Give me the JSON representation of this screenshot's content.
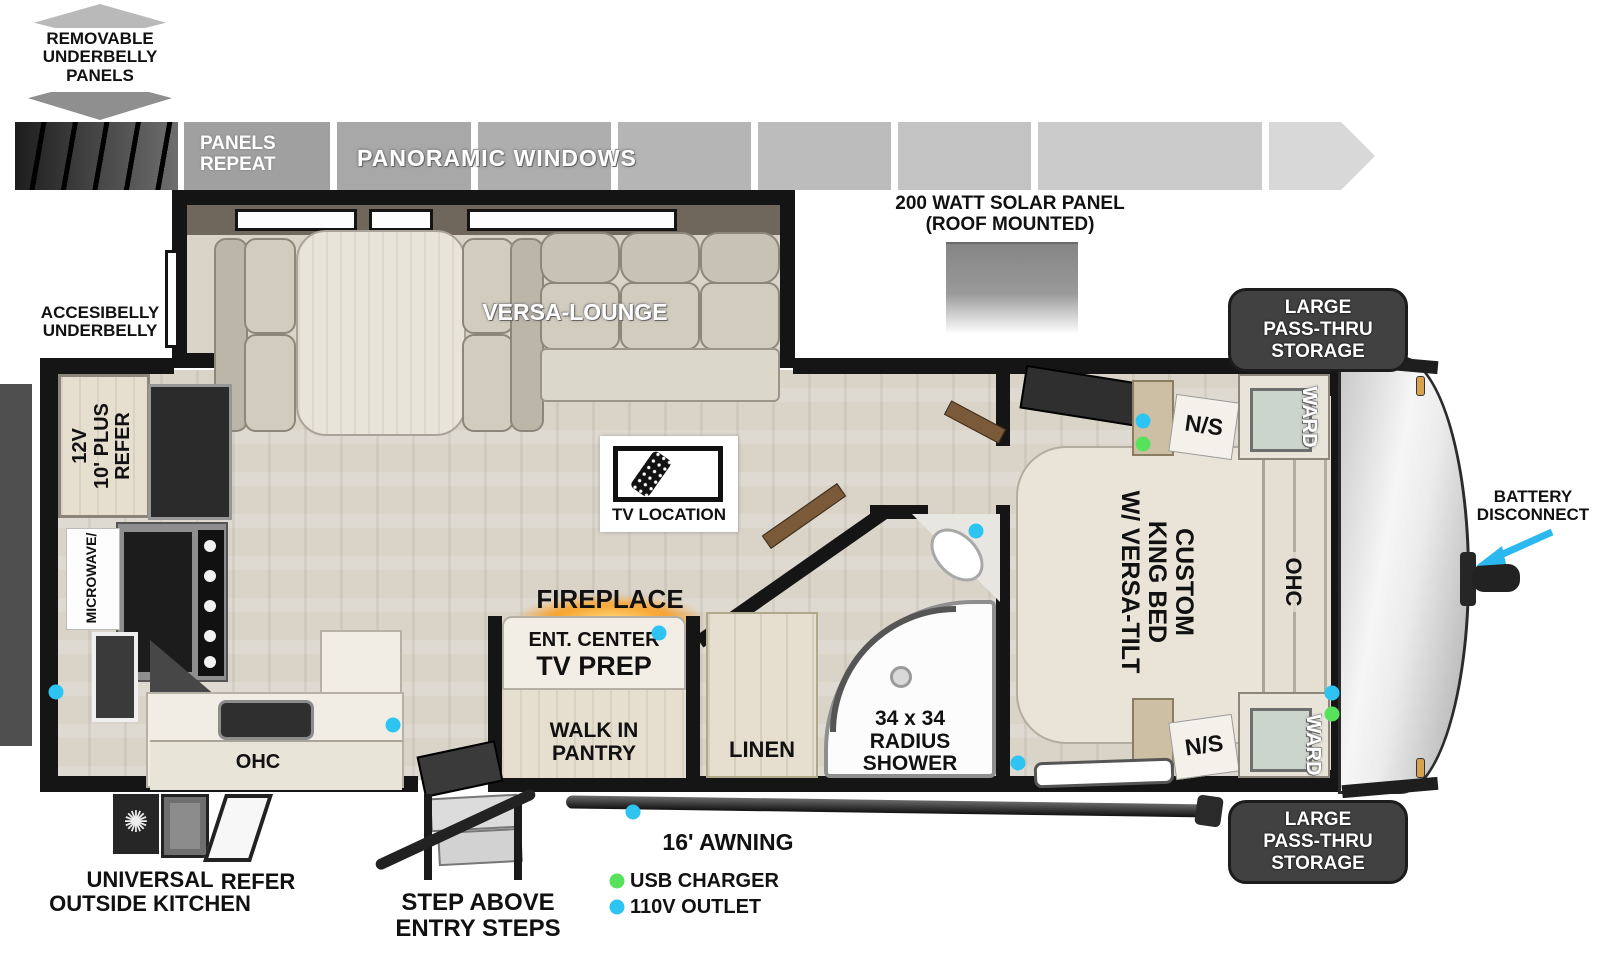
{
  "colors": {
    "outlet_110v": "#2ec4f2",
    "usb_charger": "#58e25c",
    "battery_arrow": "#2bb8ef",
    "fireplace_glow": "#f7a22e"
  },
  "top_band": {
    "removable_lines": [
      "REMOVABLE",
      "UNDERBELLY",
      "PANELS"
    ],
    "panels_repeat_lines": [
      "PANELS",
      "REPEAT"
    ],
    "panoramic_windows": "PANORAMIC WINDOWS",
    "solar_lines": [
      "200 WATT SOLAR PANEL",
      "(ROOF MOUNTED)"
    ]
  },
  "exterior": {
    "accesibelly_lines": [
      "ACCESIBELLY",
      "UNDERBELLY"
    ],
    "battery_lines": [
      "BATTERY",
      "DISCONNECT"
    ],
    "storage_lines": [
      "LARGE",
      "PASS-THRU",
      "STORAGE"
    ],
    "awning": "16' AWNING",
    "outside_kitchen_lines": [
      "UNIVERSAL",
      "OUTSIDE KITCHEN"
    ],
    "outside_refer": "REFER",
    "steps_lines": [
      "STEP ABOVE",
      "ENTRY STEPS"
    ]
  },
  "rooms": {
    "versa_lounge": "VERSA-LOUNGE",
    "tv_location": "TV LOCATION",
    "fireplace": "FIREPLACE",
    "ent_center": "ENT. CENTER",
    "tv_prep": "TV PREP",
    "pantry_lines": [
      "WALK IN",
      "PANTRY"
    ],
    "linen": "LINEN",
    "shower_lines": [
      "34 x 34",
      "RADIUS",
      "SHOWER"
    ],
    "bed_lines": [
      "CUSTOM",
      "KING BED",
      "W/ VERSA-TILT"
    ],
    "ohc_bedroom": "OHC",
    "ohc_kitchen": "OHC",
    "ward": "WARD",
    "ns": "N/S",
    "fridge_lines": [
      "12V",
      "10' PLUS",
      "REFER"
    ],
    "microwave": "MICROWAVE/"
  },
  "legend": {
    "usb": "USB CHARGER",
    "outlet": "110V OUTLET"
  },
  "outlets_110v": [
    [
      56,
      692
    ],
    [
      393,
      725
    ],
    [
      659,
      633
    ],
    [
      633,
      812
    ],
    [
      976,
      531
    ],
    [
      1018,
      763
    ],
    [
      1143,
      421
    ],
    [
      1332,
      693
    ]
  ],
  "usb_chargers": [
    [
      1143,
      444
    ],
    [
      1332,
      714
    ]
  ]
}
